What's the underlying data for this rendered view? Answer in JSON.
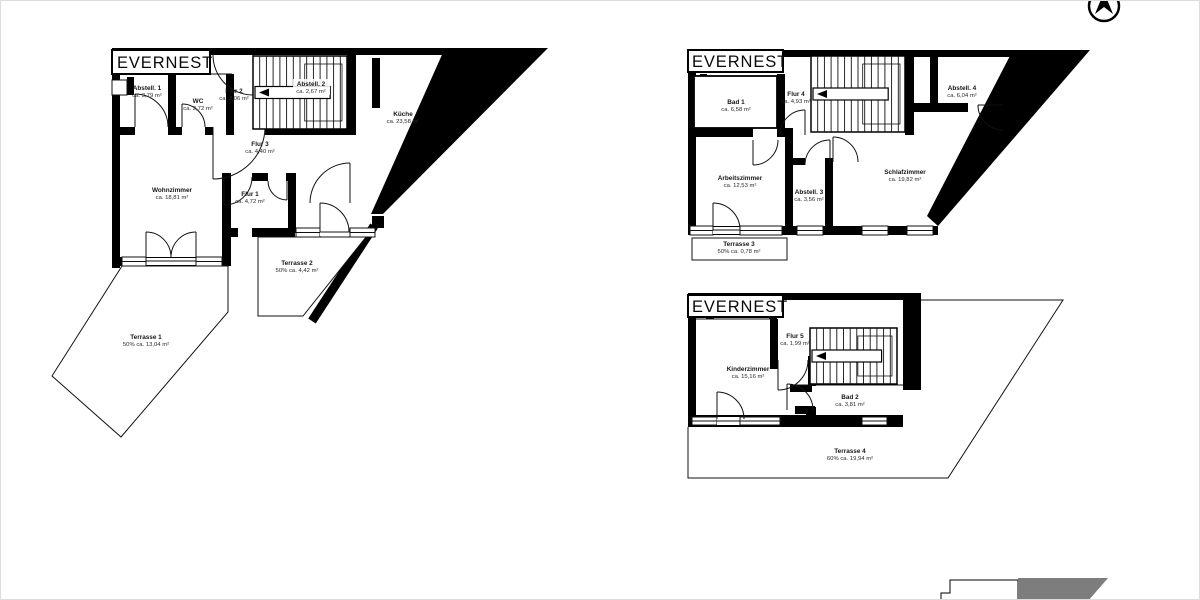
{
  "colors": {
    "background": "#ffffff",
    "wall": "#000000",
    "line": "#111111",
    "keyplan_gray": "#7d7d7d"
  },
  "icons": {
    "compass": "north-arrow",
    "keyplan": "site-key-plan-fragment"
  },
  "plans": [
    {
      "title": "EVERNEST",
      "rooms": [
        {
          "name": "Abstell. 1",
          "area": "ca. 3,79 m²"
        },
        {
          "name": "WC",
          "area": "ca. 2,72 m²"
        },
        {
          "name": "Flur 2",
          "area": "ca. 3,06 m²"
        },
        {
          "name": "Abstell. 2",
          "area": "ca. 2,67 m²"
        },
        {
          "name": "Küche",
          "area": "ca. 23,58 m²"
        },
        {
          "name": "Flur 3",
          "area": "ca. 4,40 m²"
        },
        {
          "name": "Wohnzimmer",
          "area": "ca. 18,81 m²"
        },
        {
          "name": "Flur 1",
          "area": "ca. 4,72 m²"
        },
        {
          "name": "Terrasse 2",
          "area": "50% ca. 4,42 m²"
        },
        {
          "name": "Terrasse 1",
          "area": "50% ca. 13,04 m²"
        }
      ]
    },
    {
      "title": "EVERNEST",
      "rooms": [
        {
          "name": "Bad 1",
          "area": "ca. 6,58 m²"
        },
        {
          "name": "Flur 4",
          "area": "ca. 4,93 m²"
        },
        {
          "name": "Abstell. 4",
          "area": "ca. 6,04 m²"
        },
        {
          "name": "Arbeitszimmer",
          "area": "ca. 12,53 m²"
        },
        {
          "name": "Abstell. 3",
          "area": "ca. 3,56 m²"
        },
        {
          "name": "Schlafzimmer",
          "area": "ca. 19,82 m²"
        },
        {
          "name": "Terrasse 3",
          "area": "50% ca. 0,78 m²"
        }
      ]
    },
    {
      "title": "EVERNEST",
      "rooms": [
        {
          "name": "Flur 5",
          "area": "ca. 1,99 m²"
        },
        {
          "name": "Kinderzimmer",
          "area": "ca. 15,16 m²"
        },
        {
          "name": "Bad 2",
          "area": "ca. 3,81 m²"
        },
        {
          "name": "Terrasse 4",
          "area": "60% ca. 19,94 m²"
        }
      ]
    }
  ]
}
